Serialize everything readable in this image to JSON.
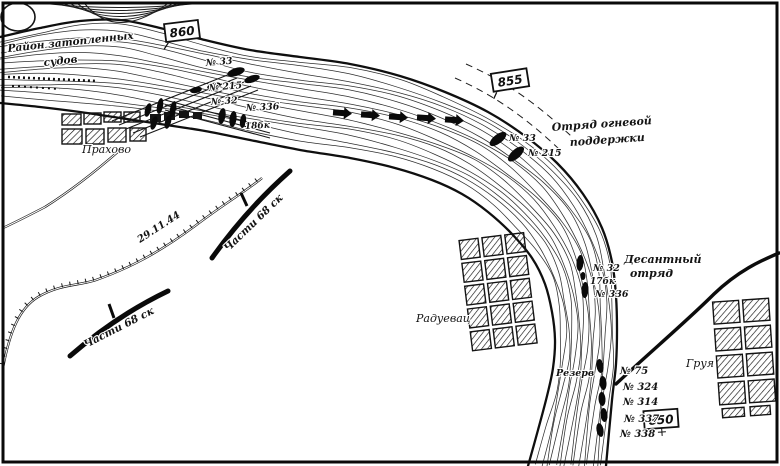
{
  "colors": {
    "ink": "#141414",
    "paper": "#ffffff"
  },
  "area_labels": {
    "sunken_line1": "Район затопленных",
    "sunken_line2": "судов"
  },
  "villages": {
    "prahovo": "Прахово",
    "raduevac": "Радуевац",
    "gruya": "Груя"
  },
  "km_markers": {
    "m860": "860",
    "m855": "855",
    "m850": "850"
  },
  "units": {
    "fire_support_line1": "Отряд огневой",
    "fire_support_line2": "поддержки",
    "landing_line1": "Десантный",
    "landing_line2": "отряд",
    "reserve": "Резерв",
    "front_a": "Части 68 ск",
    "front_b": "Части 68 ск",
    "date": "29.11.44"
  },
  "ships": {
    "port": {
      "n33": "№ 33",
      "n215": "№ 215",
      "n32": "№ 32",
      "n336": "№ 336",
      "b18": "18бк"
    },
    "fire_support": {
      "n33": "№ 33",
      "n215": "№ 215"
    },
    "landing": {
      "n32": "№ 32",
      "b17": "17бк",
      "n336": "№ 336"
    },
    "reserve": {
      "n75": "№ 75",
      "n324": "№ 324",
      "n314": "№ 314",
      "n337": "№ 337",
      "n338": "№ 338"
    }
  }
}
